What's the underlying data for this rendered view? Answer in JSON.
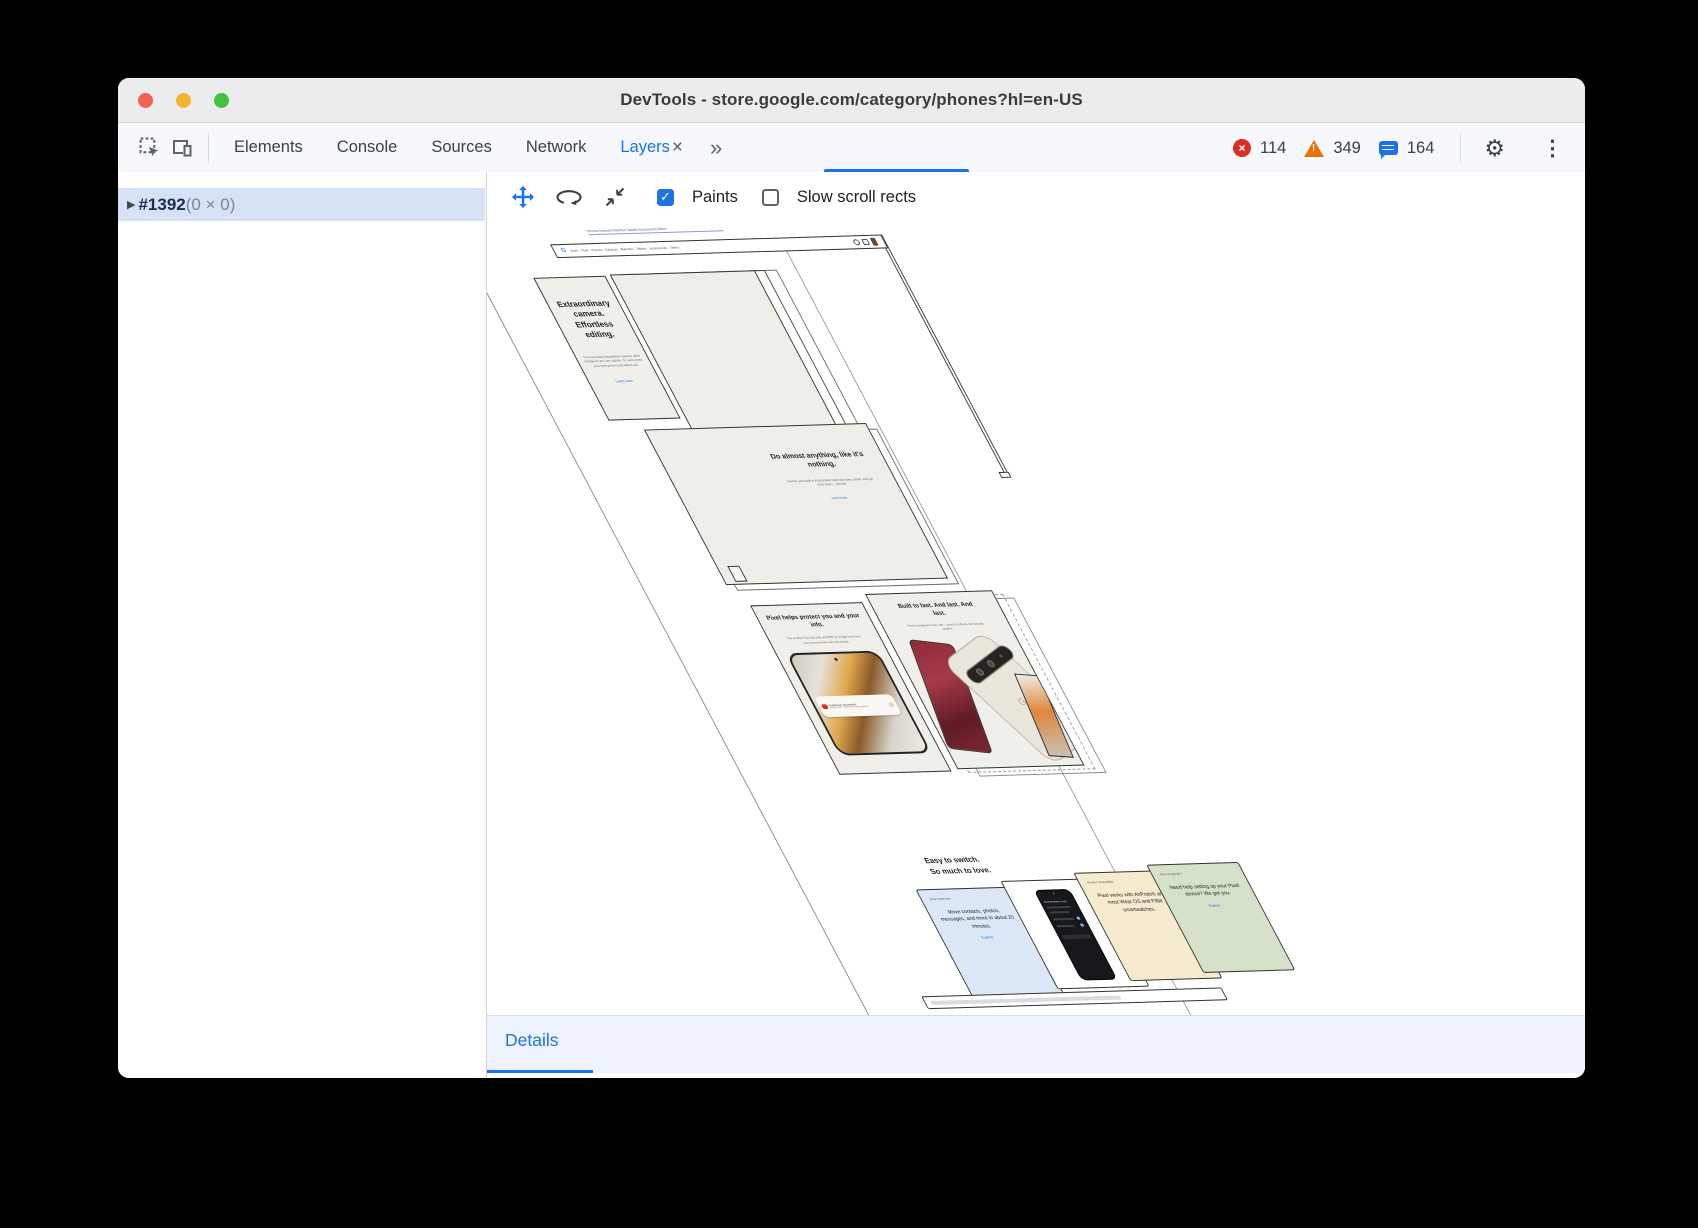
{
  "window": {
    "title": "DevTools - store.google.com/category/phones?hl=en-US"
  },
  "tabbar": {
    "tabs": [
      "Elements",
      "Console",
      "Sources",
      "Network",
      "Layers"
    ],
    "close_symbol": "×",
    "more_symbol": "»",
    "errors": "114",
    "warnings": "349",
    "issues": "164"
  },
  "sidebar": {
    "layer_id": "#1392",
    "layer_size": "(0 × 0)"
  },
  "layers_toolbar": {
    "paints": "Paints",
    "slow_scroll": "Slow scroll rects",
    "check": "✓"
  },
  "details_tab": "Details",
  "colors": {
    "accent": "#1a73e8",
    "error": "#d93025",
    "warning": "#e8710a"
  },
  "page": {
    "skip_links": "Phones Earbuds Watches Tablets Accessories Offers",
    "nav": {
      "logo": "G",
      "links": "Store   Pixel   Phones   Earbuds   Watches   Tablets   Accessories   Offers"
    },
    "hero": {
      "heading": "Extraordinary camera. Effortless editing.",
      "body": "The best-rated smartphone camera. With Google AI you can capture, fix, and create your best photos and videos yet.",
      "link": "Learn more"
    },
    "almost": {
      "heading": "Do almost anything, like it's nothing.",
      "body": "Gemini, your built-in AI assistant, helps you plan, create, and get more done — just ask.",
      "link": "Learn more"
    },
    "protect": {
      "heading": "Pixel helps protect you and your info.",
      "body": "The certified Titan M2 chip and VPN by Google help keep your personal data safe and private.",
      "alert_line1": "Suspicious call detected",
      "alert_line2": "Likely scam · caller not in your contacts"
    },
    "built": {
      "heading": "Built to last. And last. And last.",
      "body": "Pixel is designed to last, with 7 years of software and security updates.",
      "logo": "G"
    },
    "switch": {
      "heading1": "Easy to switch.",
      "heading2": "So much to love.",
      "cards": [
        {
          "label": "Easy Switch tool",
          "body": "Move contacts, photos, messages, and more in about 20 minutes.",
          "link": "Explore"
        },
        {
          "label": "Choose what to copy",
          "body": "",
          "link": ""
        },
        {
          "label": "Product compatibility",
          "body": "Pixel works with AirPods® and most Wear OS and Fitbit smartwatches.",
          "link": ""
        },
        {
          "label": "Here to help 24/7",
          "body": "Need help setting up your Pixel device? We got you.",
          "link": "Explore"
        }
      ]
    }
  }
}
